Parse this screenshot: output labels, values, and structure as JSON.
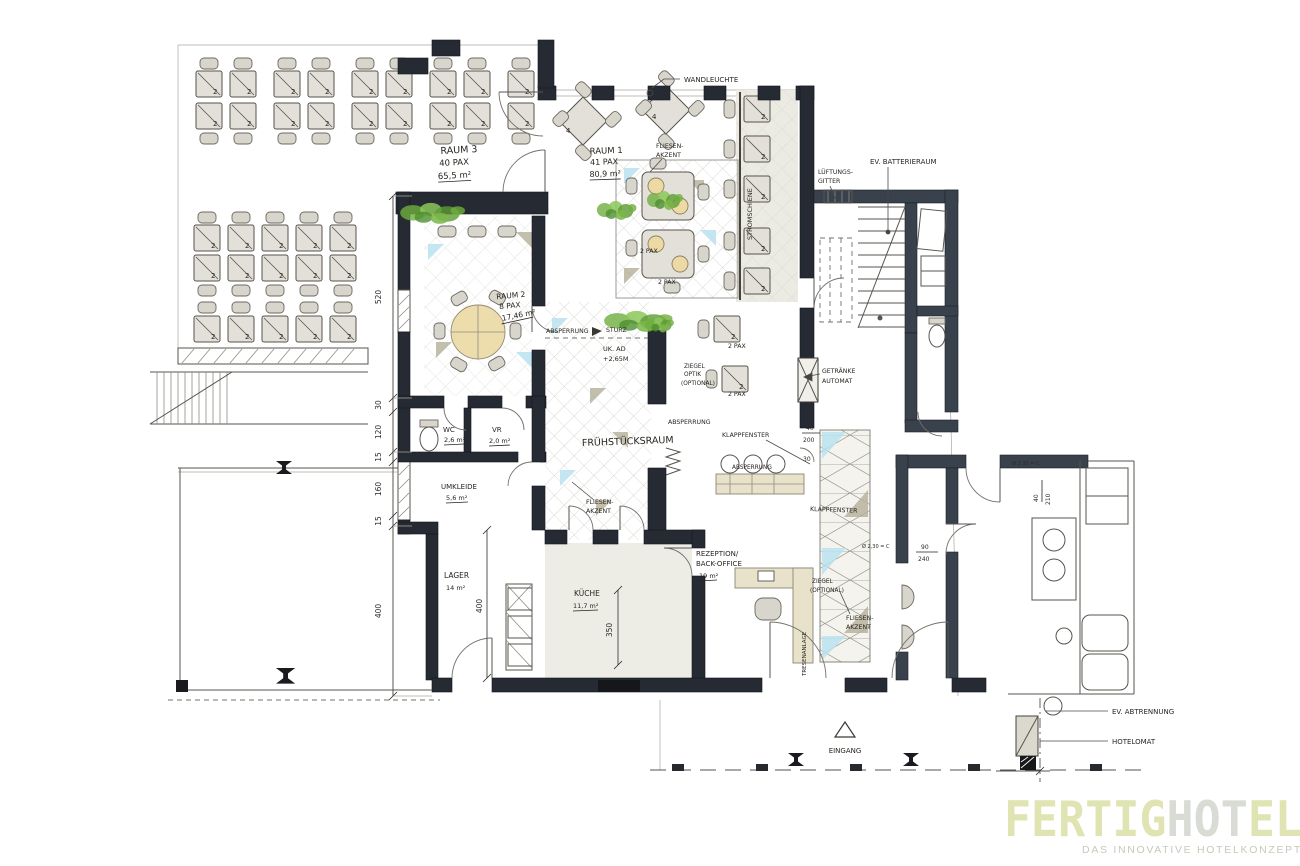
{
  "labels": {
    "wandleuchte": "WANDLEUCHTE",
    "fliesen1": "FLIESEN-",
    "fliesen2": "AKZENT",
    "stromschiene": "STROMSCHIENE",
    "ev_batterieraum": "EV. BATTERIERAUM",
    "lueftungs1": "LÜFTUNGS-",
    "lueftungs2": "GITTER",
    "absperrung": "ABSPERRUNG",
    "sturz": "STURZ",
    "uk_ad": "UK. AD",
    "uk_ad_val": "+2,65M",
    "ziegel": "ZIEGEL",
    "optik": "OPTIK",
    "optional": "(OPTIONAL)",
    "getraenke": "GETRÄNKE",
    "automat": "AUTOMAT",
    "klappfenster": "KLAPPFENSTER",
    "fruehstuecksraum": "FRÜHSTÜCKSRAUM",
    "tresenanlage": "TRESENANLAGE",
    "eingang": "EINGANG",
    "ev_abtrennung": "EV. ABTRENNUNG",
    "hotelomat": "HOTELOMAT",
    "pax2": "2 PAX",
    "seat2": "2",
    "seat4": "4",
    "ok230": "Ø 2,30 = C"
  },
  "rooms": {
    "raum3": {
      "name": "RAUM 3",
      "pax": "40 PAX",
      "area": "65,5 m²"
    },
    "raum1": {
      "name": "RAUM 1",
      "pax": "41 PAX",
      "area": "80,9 m²"
    },
    "raum2": {
      "name": "RAUM 2",
      "pax": "8 PAX",
      "area": "17,46 m²"
    },
    "wc": {
      "name": "WC",
      "area": "2,6 m²"
    },
    "vr": {
      "name": "VR",
      "area": "2,0 m²"
    },
    "umkleide": {
      "name": "UMKLEIDE",
      "area": "5,6 m²"
    },
    "lager": {
      "name": "LAGER",
      "area": "14 m²"
    },
    "kueche": {
      "name": "KÜCHE",
      "area": "11,7 m²"
    },
    "rezeption": {
      "name1": "REZEPTION/",
      "name2": "BACK-OFFICE",
      "area": "19 m²"
    }
  },
  "dimensions": {
    "chain": [
      "520",
      "30",
      "120",
      "15",
      "160",
      "15",
      "400"
    ],
    "lager_depth": "400",
    "kueche_width": "350",
    "door40": "40",
    "door200": "200",
    "door30": "30",
    "door90": "90",
    "door240": "240",
    "door210": "210"
  },
  "logo": {
    "brand1": "FERTIG",
    "brand2": "HOT",
    "brand3": "EL",
    "tagline": "DAS INNOVATIVE HOTELKONZEPT"
  },
  "colors": {
    "wall": "#262b33",
    "plant_green": "#6fae3e",
    "accent_blue": "#b9e2f0",
    "accent_olive": "#b4af99",
    "furniture": "#e2e0d8",
    "logo_green": "#dfe4b2",
    "logo_gray": "#d9dbd5"
  }
}
